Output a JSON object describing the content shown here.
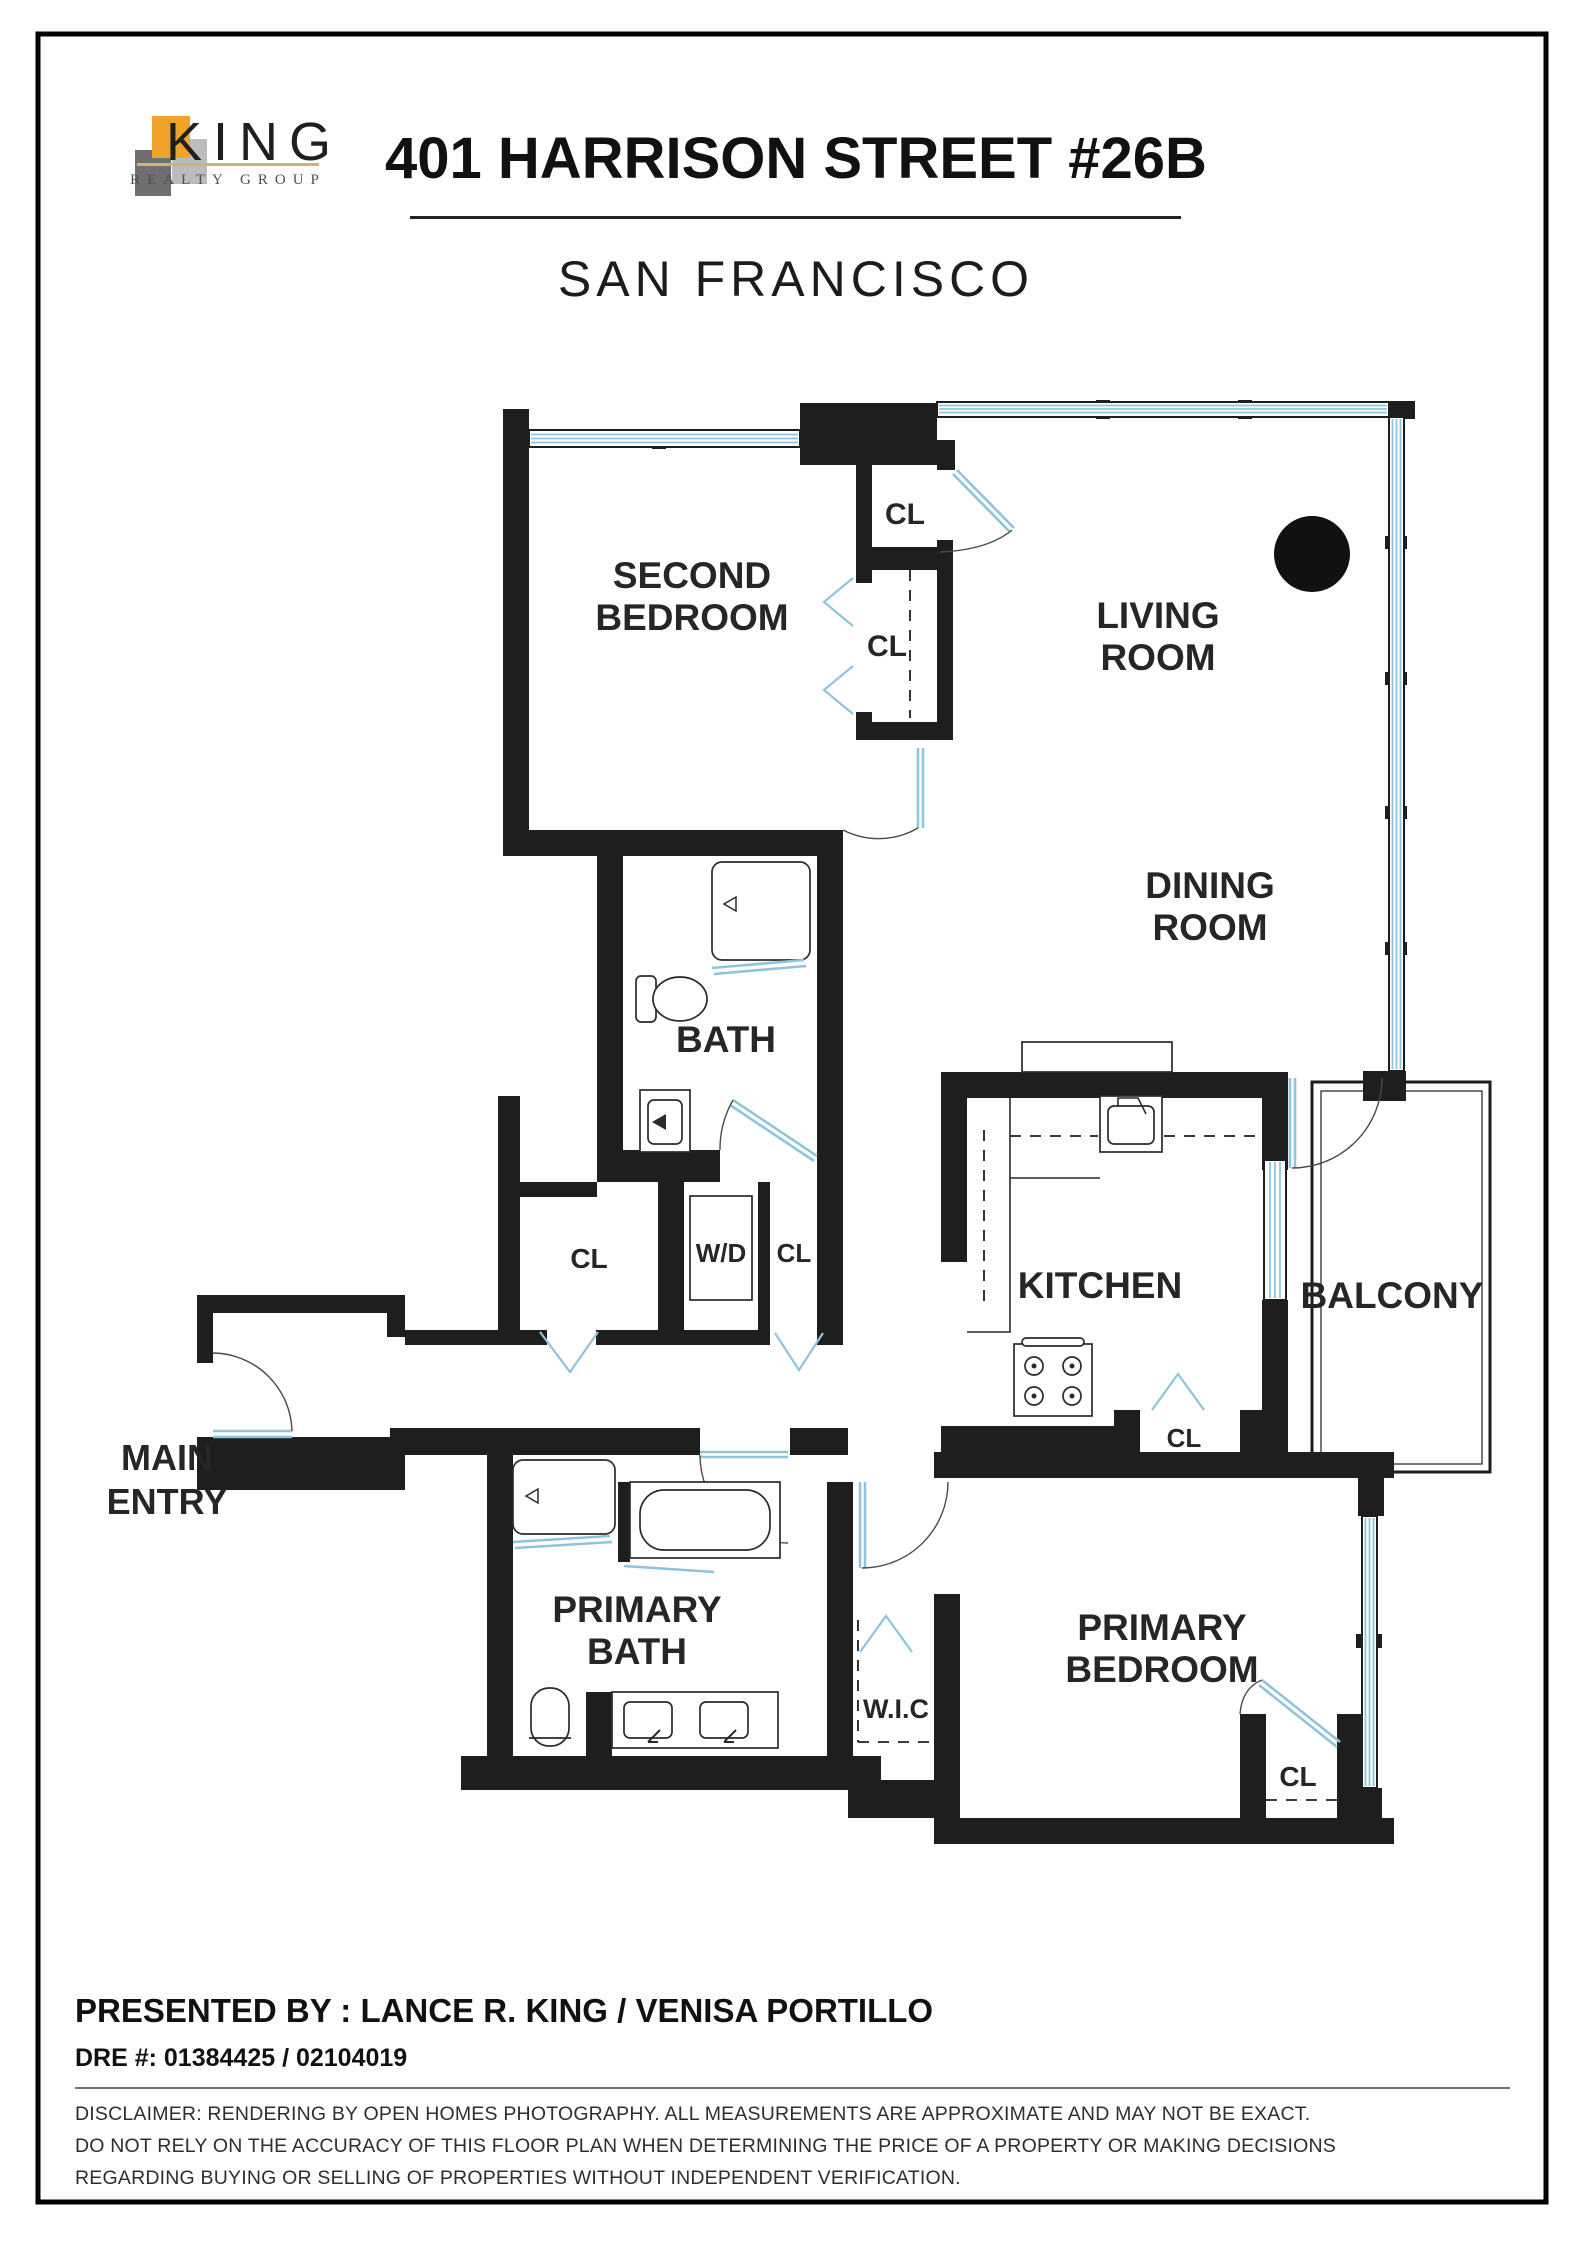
{
  "header": {
    "logo": {
      "name": "KING",
      "subtitle": "REALTY GROUP"
    },
    "title": "401 HARRISON STREET #26B",
    "subtitle": "SAN FRANCISCO"
  },
  "plan": {
    "labels": {
      "second_bedroom": {
        "line1": "SECOND",
        "line2": "BEDROOM"
      },
      "living_room": {
        "line1": "LIVING",
        "line2": "ROOM"
      },
      "dining_room": {
        "line1": "DINING",
        "line2": "ROOM"
      },
      "bath": {
        "line1": "BATH"
      },
      "kitchen": {
        "line1": "KITCHEN"
      },
      "balcony": {
        "line1": "BALCONY"
      },
      "main_entry": {
        "line1": "MAIN",
        "line2": "ENTRY"
      },
      "primary_bath": {
        "line1": "PRIMARY",
        "line2": "BATH"
      },
      "primary_bedroom": {
        "line1": "PRIMARY",
        "line2": "BEDROOM"
      },
      "wic": {
        "line1": "W.I.C"
      },
      "washer_dryer": {
        "line1": "W/D"
      },
      "closet": "CL"
    },
    "colors": {
      "wall": "#1e1e1e",
      "window": "#8ec4dc",
      "logo_orange": "#f0a32b",
      "logo_dark_gray": "#6f6f6f",
      "logo_light_gray": "#bcbcbc",
      "logo_gold": "#d2b271"
    }
  },
  "footer": {
    "presented_by": "PRESENTED BY : LANCE R. KING / VENISA PORTILLO",
    "dre": "DRE #: 01384425 / 02104019",
    "disclaimer_lines": [
      "DISCLAIMER: RENDERING BY OPEN HOMES PHOTOGRAPHY. ALL MEASUREMENTS ARE APPROXIMATE AND MAY NOT BE EXACT.",
      "DO NOT RELY ON THE ACCURACY OF THIS FLOOR PLAN WHEN DETERMINING THE PRICE OF A PROPERTY OR MAKING DECISIONS",
      "REGARDING BUYING OR SELLING OF PROPERTIES WITHOUT INDEPENDENT VERIFICATION."
    ]
  }
}
